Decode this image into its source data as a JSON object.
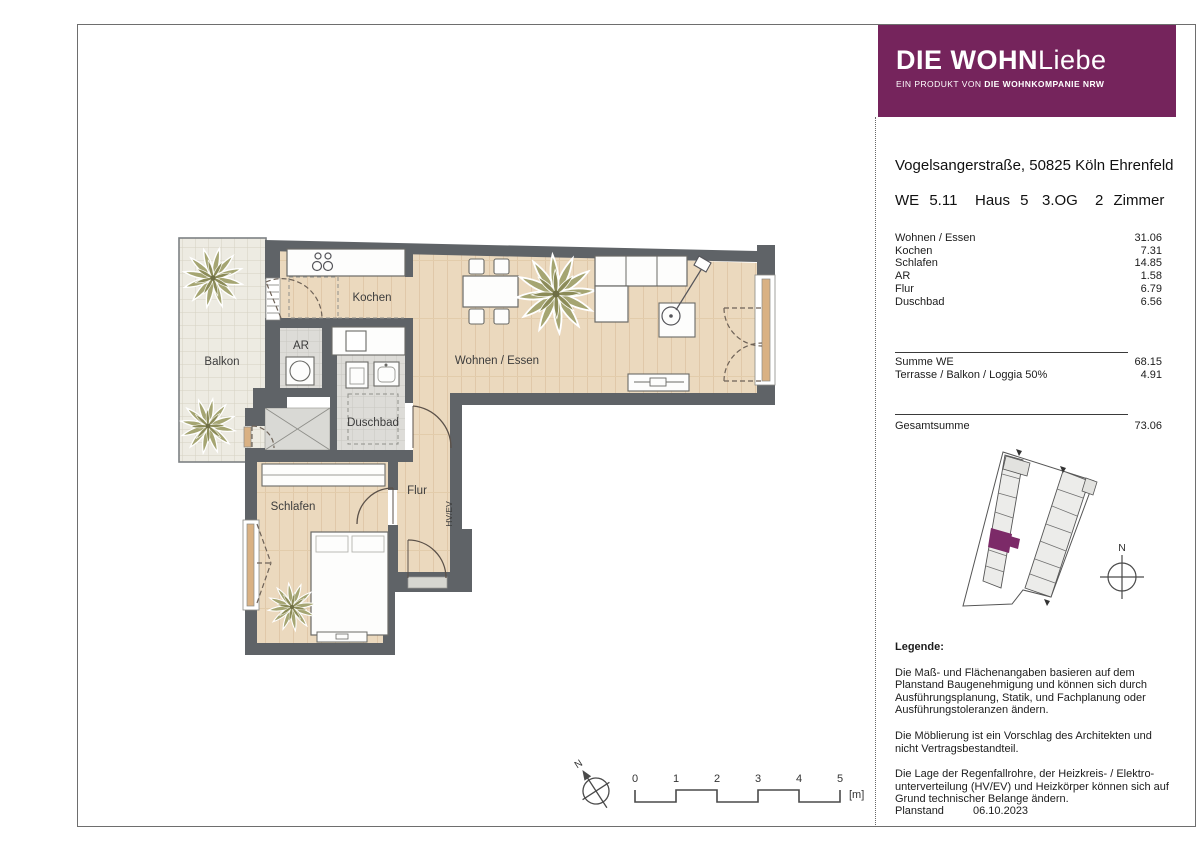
{
  "logo": {
    "brand_bold": "DIE WOHN",
    "brand_light": "Liebe",
    "tagline_prefix": "EIN PRODUKT VON ",
    "tagline_bold": "DIE WOHNKOMPANIE NRW"
  },
  "colors": {
    "brand_purple": "#75245c",
    "wall_gray": "#5f6367",
    "wood_floor": "#ebd9be",
    "site_highlight_purple": "#7c2a68"
  },
  "header": {
    "address": "Vogelsangerstraße, 50825 Köln Ehrenfeld",
    "unit": "WE 5.11",
    "house": "Haus 5",
    "floor": "3.OG",
    "rooms": "2 Zimmer"
  },
  "area_table": {
    "rows": [
      {
        "name": "Wohnen / Essen",
        "area": "31.06"
      },
      {
        "name": "Kochen",
        "area": "7.31"
      },
      {
        "name": "Schlafen",
        "area": "14.85"
      },
      {
        "name": "AR",
        "area": "1.58"
      },
      {
        "name": "Flur",
        "area": "6.79"
      },
      {
        "name": "Duschbad",
        "area": "6.56"
      }
    ],
    "sum_rows": [
      {
        "name": "Summe WE",
        "area": "68.15"
      },
      {
        "name": "Terrasse / Balkon / Loggia 50%",
        "area": "4.91"
      }
    ],
    "total": {
      "name": "Gesamtsumme",
      "area": "73.06"
    }
  },
  "legend": {
    "title": "Legende:",
    "p1": "Die Maß- und Flächenangaben basieren auf dem Planstand Baugenehmigung und können sich durch Ausführungsplanung, Statik, und Fachplanung oder Ausführungstoleranzen ändern.",
    "p2": "Die Möblierung ist ein Vorschlag des Architekten und nicht Vertragsbestandteil.",
    "p3": "Die Lage der Regenfallrohre, der Heizkreis- / Elektro- unterverteilung (HV/EV) und Heizkörper können sich auf Grund technischer Belange ändern.",
    "planstand_label": "Planstand",
    "planstand_date": "06.10.2023"
  },
  "plan_labels": {
    "balkon": "Balkon",
    "kochen": "Kochen",
    "ar": "AR",
    "duschbad": "Duschbad",
    "wohnen_essen": "Wohnen / Essen",
    "flur": "Flur",
    "hvev": "HV/EV",
    "schlafen": "Schlafen"
  },
  "scale_bar": {
    "ticks": [
      "0",
      "1",
      "2",
      "3",
      "4",
      "5"
    ],
    "unit": "[m]"
  },
  "compass": {
    "north": "N"
  }
}
